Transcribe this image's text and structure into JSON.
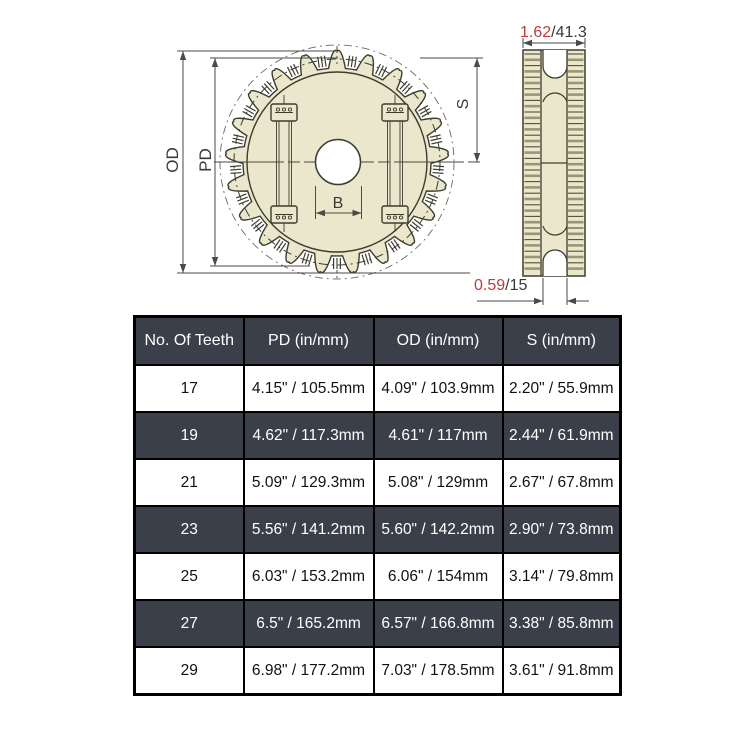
{
  "drawing": {
    "front_view": {
      "od_label": "OD",
      "pd_label": "PD",
      "bore_label": "B",
      "s_label": "S"
    },
    "side_view": {
      "width_dim_in": "1.62",
      "width_dim_mm": "/41.3",
      "groove_dim_in": "0.59",
      "groove_dim_mm": "/15"
    },
    "colors": {
      "accent_red": "#c13b3b",
      "body_fill": "#eae7cc",
      "line": "#3d3d2f",
      "dim_line": "#4a4a46",
      "stripe_olive": "#9a9673",
      "stripe_dark": "#4e4c38",
      "table_dark": "#3b3f4a"
    }
  },
  "table": {
    "headers": [
      "No. Of Teeth",
      "PD (in/mm)",
      "OD (in/mm)",
      "S (in/mm)"
    ],
    "rows": [
      {
        "teeth": "17",
        "pd": "4.15\" / 105.5mm",
        "od": "4.09\" / 103.9mm",
        "s": "2.20\" / 55.9mm"
      },
      {
        "teeth": "19",
        "pd": "4.62\" / 117.3mm",
        "od": "4.61\" / 117mm",
        "s": "2.44\" / 61.9mm"
      },
      {
        "teeth": "21",
        "pd": "5.09\" / 129.3mm",
        "od": "5.08\" / 129mm",
        "s": "2.67\" / 67.8mm"
      },
      {
        "teeth": "23",
        "pd": "5.56\" / 141.2mm",
        "od": "5.60\" / 142.2mm",
        "s": "2.90\" / 73.8mm"
      },
      {
        "teeth": "25",
        "pd": "6.03\" / 153.2mm",
        "od": "6.06\" / 154mm",
        "s": "3.14\" / 79.8mm"
      },
      {
        "teeth": "27",
        "pd": "6.5\" / 165.2mm",
        "od": "6.57\" / 166.8mm",
        "s": "3.38\" / 85.8mm"
      },
      {
        "teeth": "29",
        "pd": "6.98\" / 177.2mm",
        "od": "7.03\" / 178.5mm",
        "s": "3.61\" / 91.8mm"
      }
    ]
  }
}
